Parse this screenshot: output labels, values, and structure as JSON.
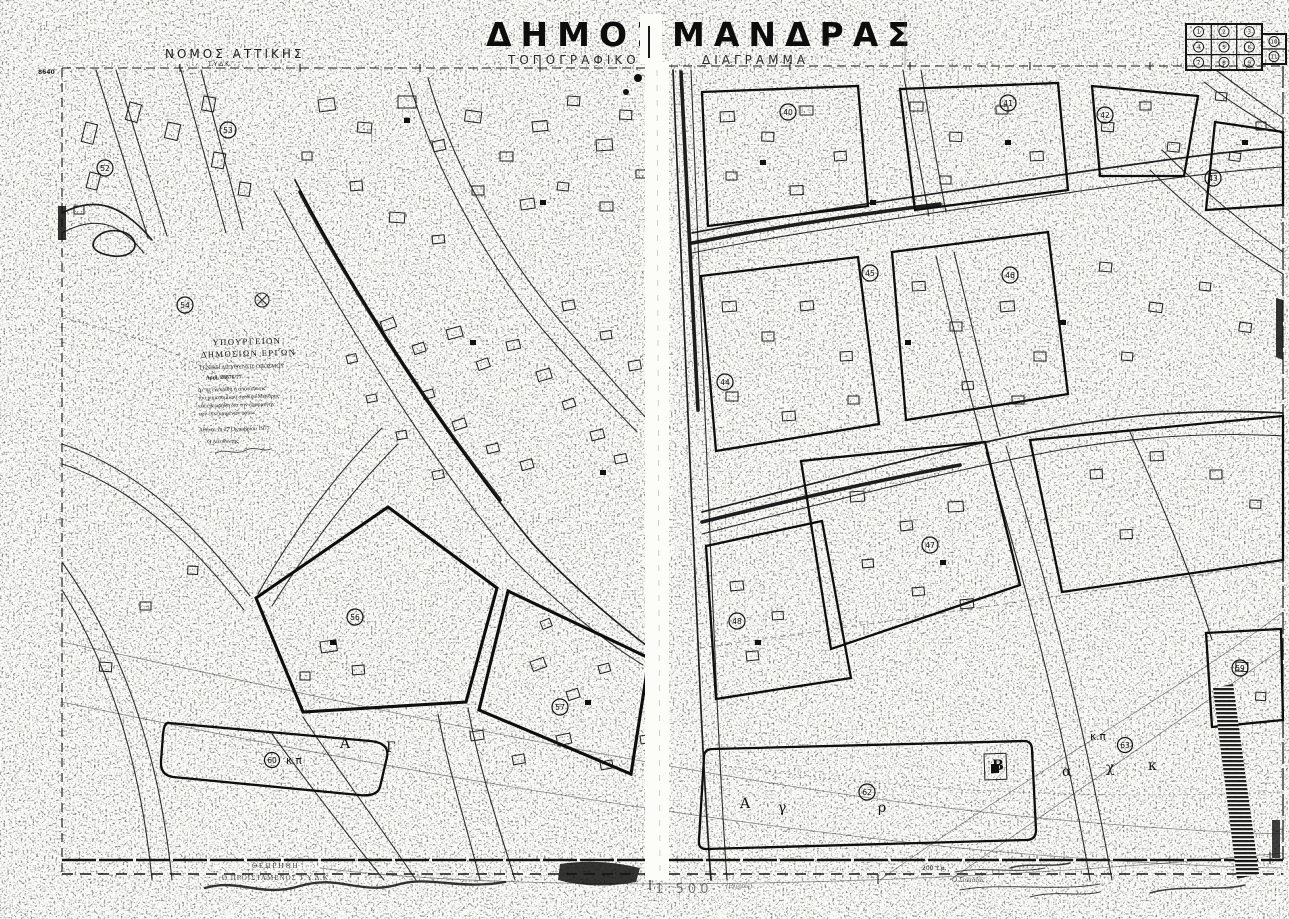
{
  "page": {
    "title_left": "ΔΗΜΟΣ",
    "title_right": "ΜΑΝΔΡΑΣ",
    "subtitle_left": "ΤΟΠΟΓΡΑΦΙΚΟΝ",
    "subtitle_right": "ΔΙΑΓΡΑΜΜΑ"
  },
  "header": {
    "region": "ΝΟΜΟΣ ΑΤΤΙΚΗΣ",
    "region_sub": "Τ.Υ.Δ.Κ.",
    "edge_number": "8640"
  },
  "sheet_index": {
    "cells": [
      "1",
      "2",
      "3",
      "4",
      "5",
      "6",
      "7",
      "8",
      "9"
    ],
    "side": [
      "10",
      "11"
    ]
  },
  "stamp": {
    "l1": "ΥΠΟΥΡΓΕΙΟΝ",
    "l2": "ΔΗΜΟΣΙΩΝ ΕΡΓΩΝ",
    "l3": "ΓΕΝΙΚΗ ΔΙΕΥΘΥΝΣΙΣ ΟΙΚΙΣΜΟΥ",
    "l4": "Αριθ. 28876/77",
    "l5": "Δι' ης ενεκρίθη η αποτύπωσις",
    "l6": "του ρυμοτομικού σχεδίου Μάνδρας",
    "l7": "και εθεωρήθη δια την εφαρμογήν",
    "l8": "των εγκεκριμένων ορίων",
    "l9": "Αθήναι τη 27 Οκτωβρίου 1977",
    "l10": "Ο Διευθυντής"
  },
  "blocks": [
    {
      "n": "52"
    },
    {
      "n": "53"
    },
    {
      "n": "54"
    },
    {
      "n": "56"
    },
    {
      "n": "57"
    },
    {
      "n": "60"
    },
    {
      "n": "40"
    },
    {
      "n": "41"
    },
    {
      "n": "42"
    },
    {
      "n": "43"
    },
    {
      "n": "44"
    },
    {
      "n": "45"
    },
    {
      "n": "46"
    },
    {
      "n": "47"
    },
    {
      "n": "48"
    },
    {
      "n": "62"
    },
    {
      "n": "63"
    },
    {
      "n": "59"
    }
  ],
  "labels": {
    "kp_left": "κ.π",
    "kp_right": "κ.π",
    "b_mark": "Β",
    "letter_a_left": "Α",
    "letter_g_left": "Γ",
    "field_a": "Α",
    "field_g": "γ",
    "field_r": "ρ",
    "row_a": "α",
    "row_x": "χ",
    "row_k": "κ"
  },
  "footer": {
    "approved": "ΘΕΩΡΗΘΗ",
    "approver": "Ο ΠΡΟΪΣΤΑΜΕΝΟΣ Τ.Υ.Δ.Κ.",
    "scale": "1:500",
    "place": "(Ελευσίς)",
    "area_note": "200 τ.μ.",
    "drafter": "Ο Συντάξας"
  }
}
